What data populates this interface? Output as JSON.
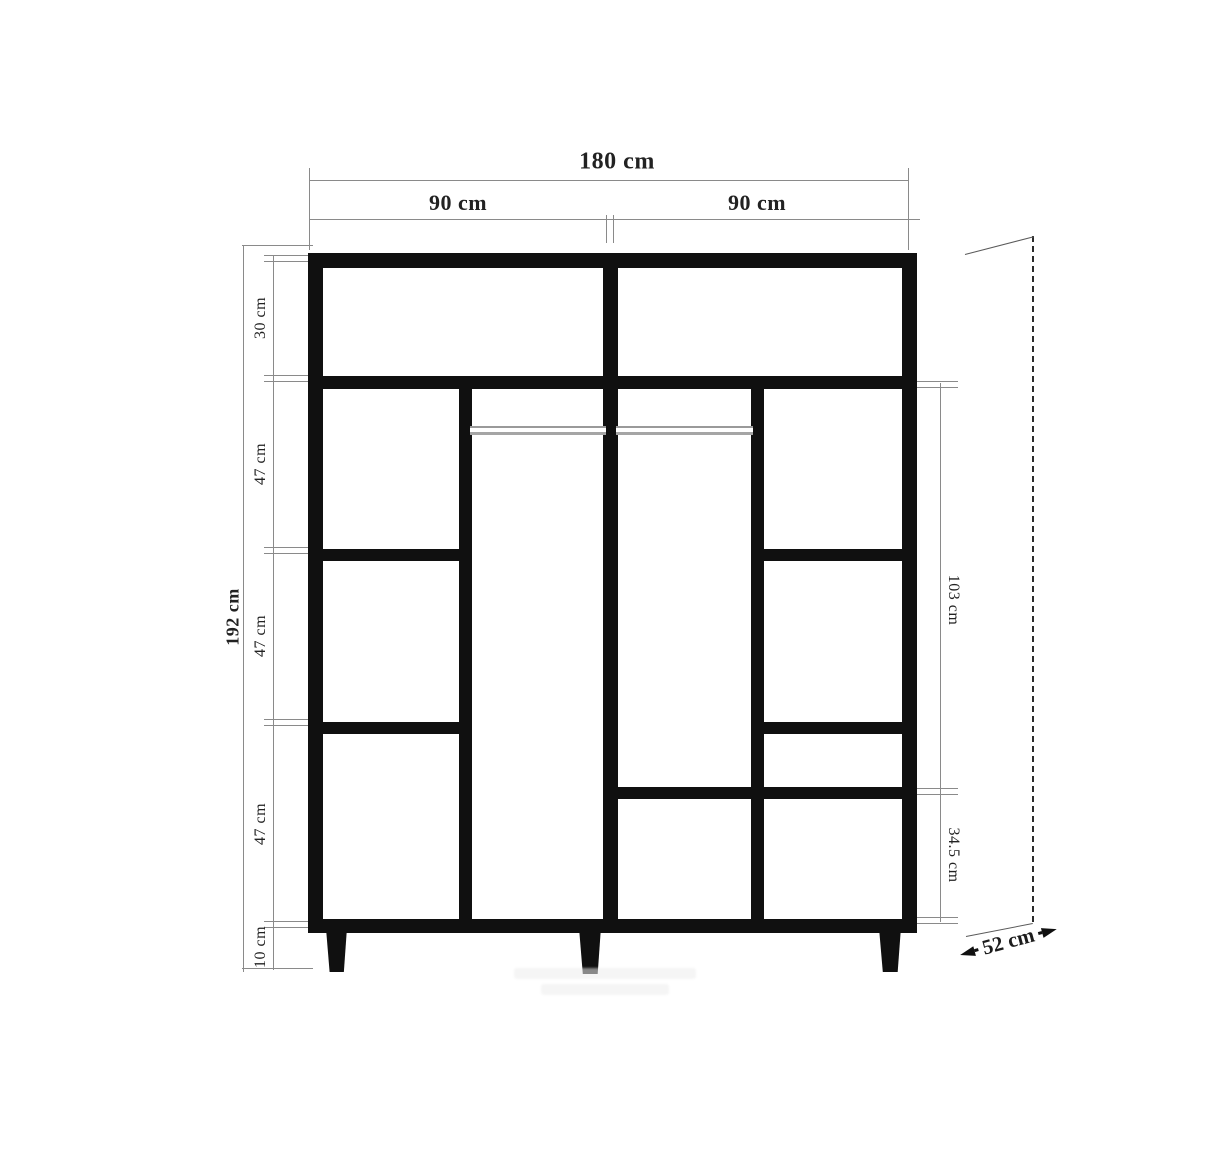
{
  "diagram": {
    "type": "furniture-technical-drawing",
    "subject": "wardrobe front elevation with dimension lines"
  },
  "measurements": {
    "total_width": "180 cm",
    "door_width_left": "90 cm",
    "door_width_right": "90 cm",
    "total_height": "192 cm",
    "height_segments": [
      "30 cm",
      "47 cm",
      "47 cm",
      "47 cm",
      "10 cm"
    ],
    "hanging_section_height": "103 cm",
    "lower_section_height": "34.5 cm",
    "depth": "52 cm"
  },
  "colors": {
    "structure": "#101010",
    "dimension_lines": "#8a8a8a",
    "hanging_rod": "#9a9a9a",
    "background": "#ffffff"
  }
}
